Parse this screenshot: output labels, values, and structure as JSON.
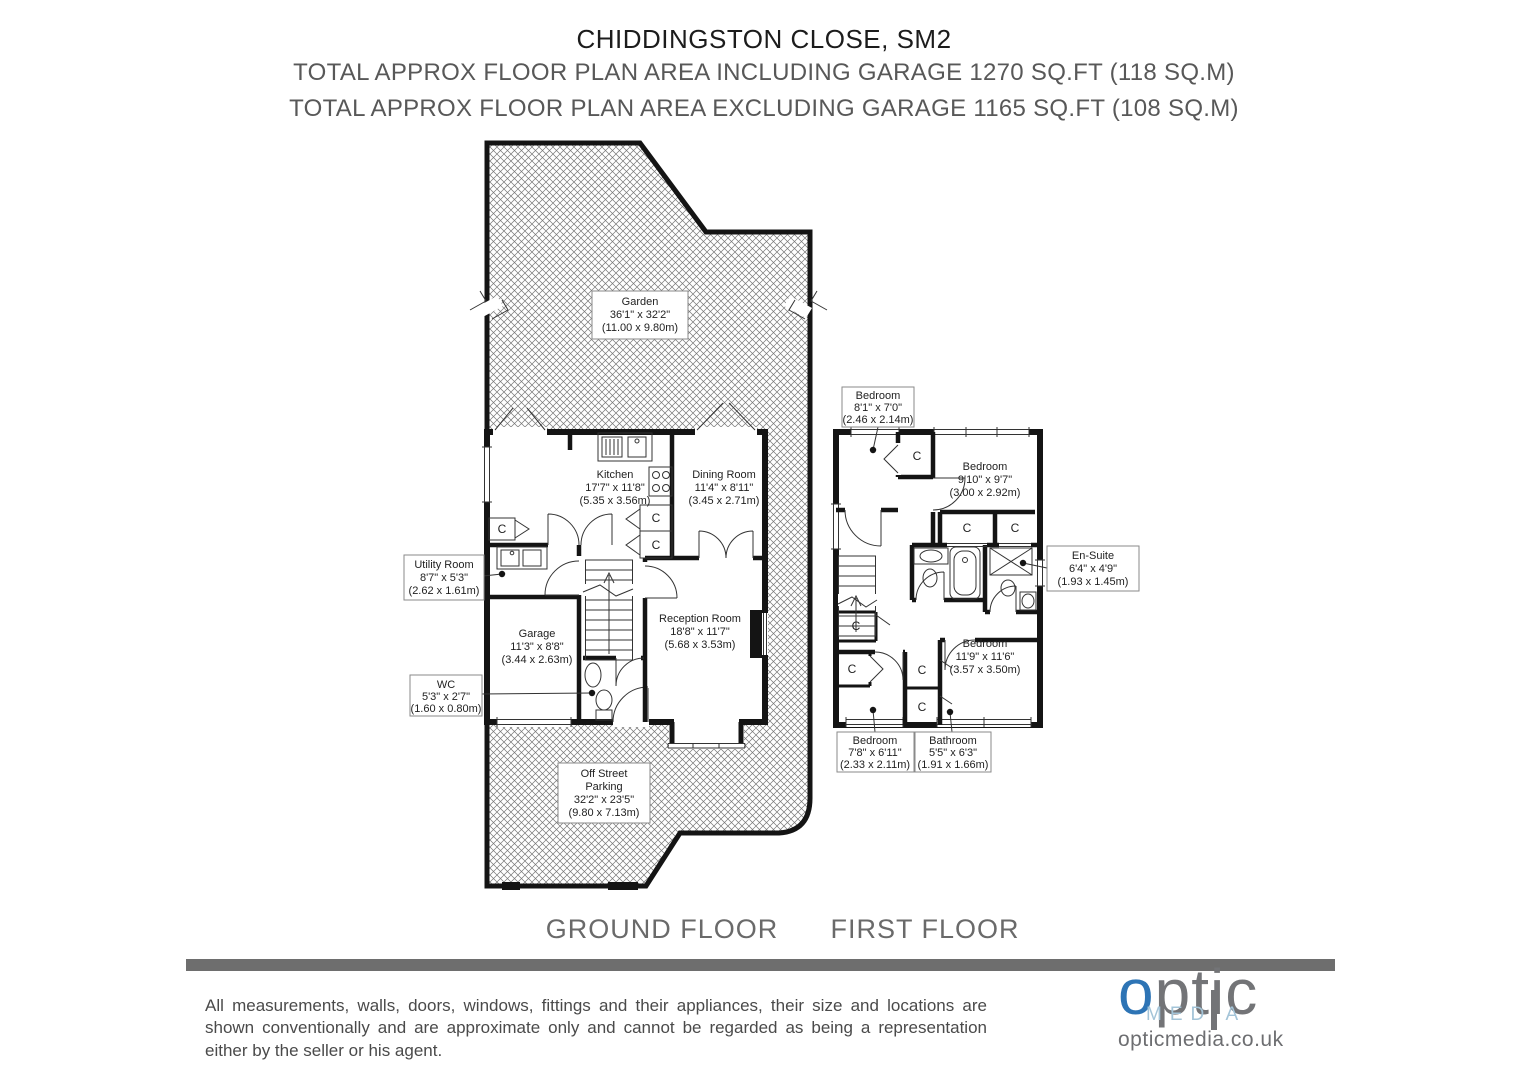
{
  "header": {
    "title": "CHIDDINGSTON CLOSE, SM2",
    "subtitle1": "TOTAL APPROX FLOOR PLAN AREA INCLUDING GARAGE 1270 SQ.FT (118 SQ.M)",
    "subtitle2": "TOTAL APPROX FLOOR PLAN AREA EXCLUDING GARAGE 1165 SQ.FT (108 SQ.M)"
  },
  "plan": {
    "ground_floor_label": "GROUND FLOOR",
    "first_floor_label": "FIRST FLOOR",
    "cupboard": "C",
    "rooms": {
      "garden": {
        "name": "Garden",
        "imperial": "36'1\" x 32'2\"",
        "metric": "(11.00 x 9.80m)"
      },
      "kitchen": {
        "name": "Kitchen",
        "imperial": "17'7\" x 11'8\"",
        "metric": "(5.35 x 3.56m)"
      },
      "dining": {
        "name": "Dining Room",
        "imperial": "11'4\" x 8'11\"",
        "metric": "(3.45 x 2.71m)"
      },
      "utility": {
        "name": "Utility Room",
        "imperial": "8'7\" x 5'3\"",
        "metric": "(2.62 x 1.61m)"
      },
      "garage": {
        "name": "Garage",
        "imperial": "11'3\" x 8'8\"",
        "metric": "(3.44 x 2.63m)"
      },
      "wc": {
        "name": "WC",
        "imperial": "5'3\" x 2'7\"",
        "metric": "(1.60 x 0.80m)"
      },
      "reception": {
        "name": "Reception Room",
        "imperial": "18'8\" x 11'7\"",
        "metric": "(5.68 x 3.53m)"
      },
      "parking": {
        "name_line1": "Off Street",
        "name_line2": "Parking",
        "imperial": "32'2\" x 23'5\"",
        "metric": "(9.80 x 7.13m)"
      },
      "bedroom1": {
        "name": "Bedroom",
        "imperial": "8'1\" x 7'0\"",
        "metric": "(2.46 x 2.14m)"
      },
      "bedroom2": {
        "name": "Bedroom",
        "imperial": "9'10\" x 9'7\"",
        "metric": "(3.00 x 2.92m)"
      },
      "ensuite": {
        "name": "En-Suite",
        "imperial": "6'4\" x 4'9\"",
        "metric": "(1.93 x 1.45m)"
      },
      "bedroom3": {
        "name": "Bedroom",
        "imperial": "11'9\" x 11'6\"",
        "metric": "(3.57 x 3.50m)"
      },
      "bedroom4": {
        "name": "Bedroom",
        "imperial": "7'8\" x 6'11\"",
        "metric": "(2.33 x 2.11m)"
      },
      "bathroom": {
        "name": "Bathroom",
        "imperial": "5'5\" x 6'3\"",
        "metric": "(1.91 x 1.66m)"
      }
    }
  },
  "footer": {
    "disclaimer": "All measurements, walls, doors, windows, fittings and their appliances, their size and locations are shown conventionally and are approximate only and cannot be regarded as being a representation either by the seller or his agent.",
    "divider_color": "#6e6e6e",
    "logo": {
      "optic_o": "o",
      "optic_rest": "ptic",
      "media_pre": "MED",
      "media_i": "I",
      "media_post": "A",
      "website": "opticmedia.co.uk",
      "blue": "#2d74b5",
      "gray": "#737477",
      "light_blue": "#a3c4d8"
    }
  }
}
